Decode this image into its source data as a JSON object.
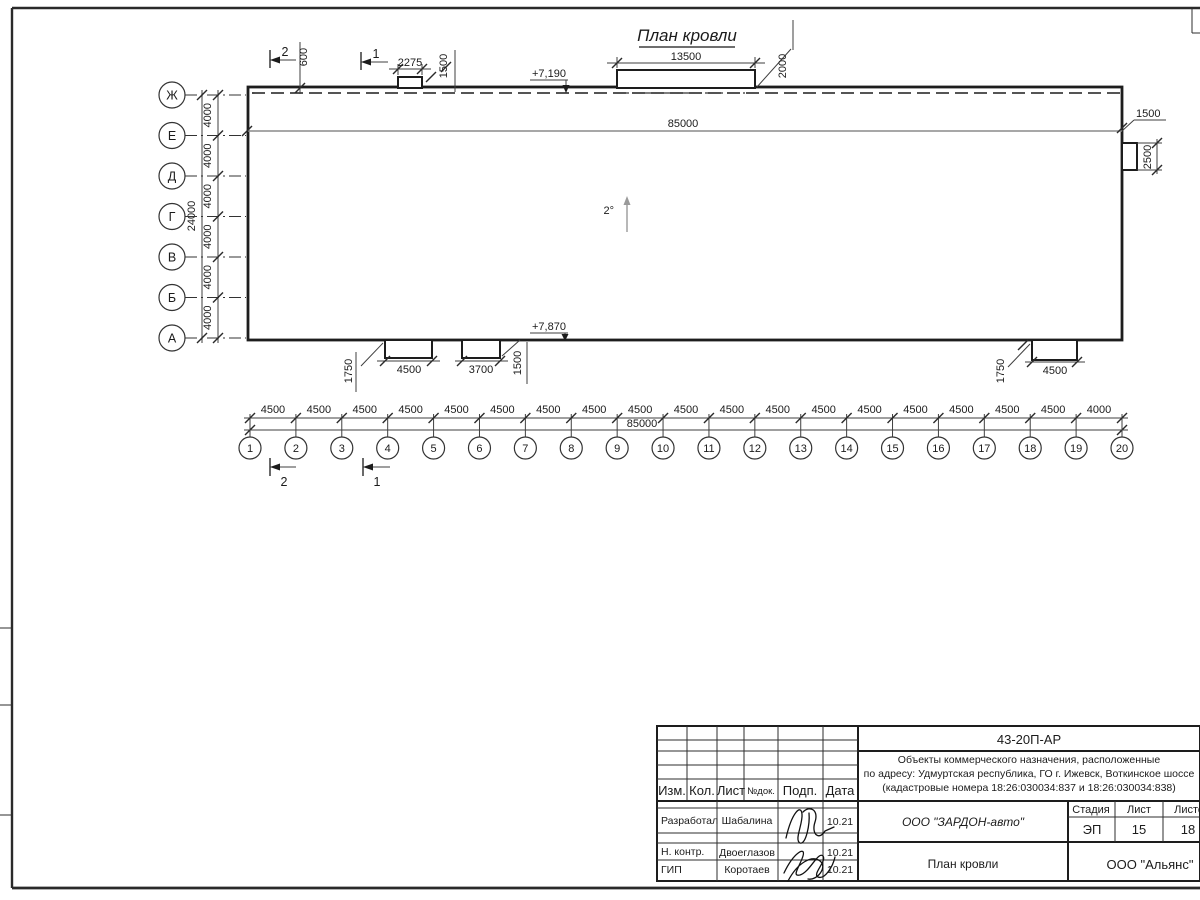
{
  "sheet": {
    "title": "План кровли"
  },
  "plan": {
    "slope": "2°",
    "elev_top": "+7,190",
    "elev_bottom": "+7,870",
    "total_top": "85000",
    "dim_600": "600",
    "hatch_small": {
      "width": "2275",
      "depth": "1500"
    },
    "hatch_large": {
      "width": "13500",
      "depth": "2000"
    },
    "right_unit": {
      "offset": "1500",
      "depth": "2500"
    },
    "canopy_left": {
      "width": "4500",
      "offset": "1750"
    },
    "canopy_mid": {
      "width": "3700",
      "offset": "1500"
    },
    "canopy_right": {
      "width": "4500",
      "offset": "1750"
    },
    "section_1": "1",
    "section_2": "2"
  },
  "axes": {
    "left": {
      "labels": [
        "Ж",
        "Е",
        "Д",
        "Г",
        "В",
        "Б",
        "А"
      ],
      "spacings": [
        "4000",
        "4000",
        "4000",
        "4000",
        "4000",
        "4000"
      ],
      "total": "24000"
    },
    "bottom": {
      "labels": [
        "1",
        "2",
        "3",
        "4",
        "5",
        "6",
        "7",
        "8",
        "9",
        "10",
        "11",
        "12",
        "13",
        "14",
        "15",
        "16",
        "17",
        "18",
        "19",
        "20"
      ],
      "spacings": [
        "4500",
        "4500",
        "4500",
        "4500",
        "4500",
        "4500",
        "4500",
        "4500",
        "4500",
        "4500",
        "4500",
        "4500",
        "4500",
        "4500",
        "4500",
        "4500",
        "4500",
        "4500",
        "4000"
      ],
      "total": "85000"
    }
  },
  "titleblock": {
    "doc_number": "43-20П-АР",
    "address_lines": [
      "Объекты коммерческого назначения, расположенные",
      "по адресу: Удмуртская республика, ГО г. Ижевск, Воткинское шоссе",
      "(кадастровые номера 18:26:030034:837 и 18:26:030034:838)"
    ],
    "header_cols": [
      "Изм.",
      "Кол.",
      "Лист",
      "№док.",
      "Подп.",
      "Дата"
    ],
    "rows": [
      {
        "role": "Разработал",
        "name": "Шабалина",
        "date": "10.21"
      },
      {
        "role": "Н. контр.",
        "name": "Двоеглазов",
        "date": "10.21"
      },
      {
        "role": "ГИП",
        "name": "Коротаев",
        "date": "10.21"
      }
    ],
    "company": "ООО \"ЗАРДОН-авто\"",
    "stage_label": "Стадия",
    "sheet_label": "Лист",
    "sheets_label": "Листов",
    "stage": "ЭП",
    "sheet": "15",
    "sheets": "18",
    "drawing_name": "План кровли",
    "org": "ООО \"Альянс\""
  }
}
